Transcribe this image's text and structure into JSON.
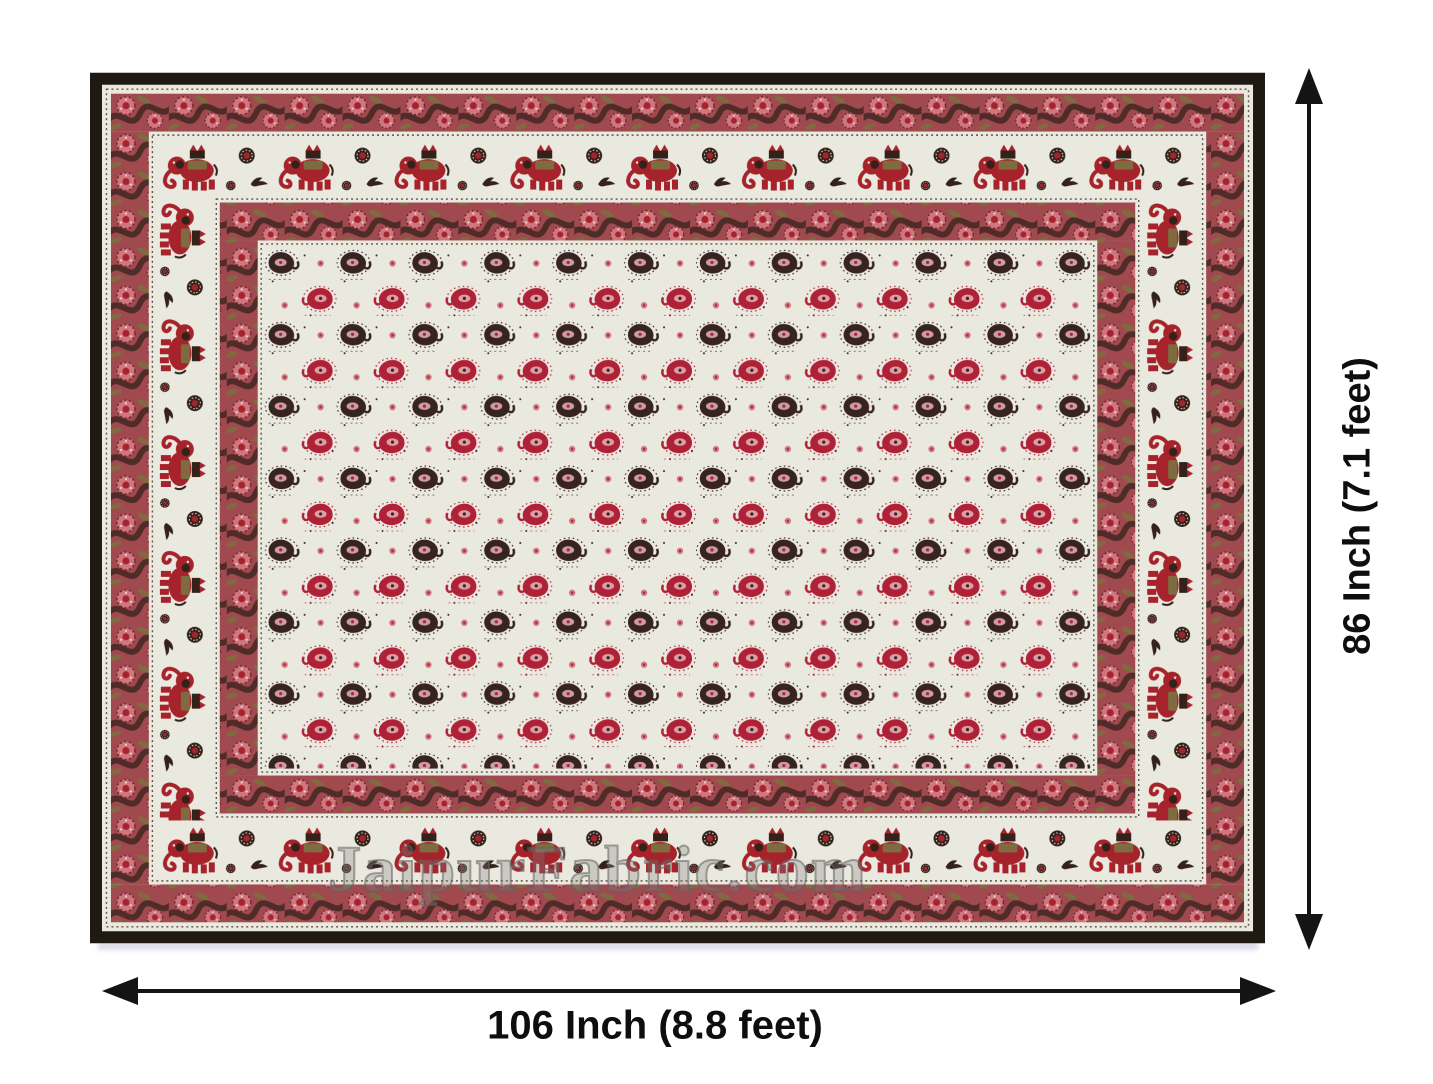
{
  "watermark": {
    "text": "JaipurFabric.com"
  },
  "dimension_labels": {
    "width": "106 Inch (8.8 feet)",
    "height": "86 Inch (7.1 feet)"
  },
  "icons": {
    "width_arrow": "double-headed-arrow-horizontal",
    "height_arrow": "double-headed-arrow-vertical"
  },
  "palette": {
    "page_bg": "#ffffff",
    "arrow_black": "#141414",
    "label_black": "#0e0e0e",
    "edge_black": "#201913",
    "cream": "#eae9df",
    "band_bg": "#a04a50",
    "motif_red": "#a6232b",
    "motif_dark": "#34211a",
    "paisley_dark": "#372322",
    "paisley_red": "#ae2136",
    "pink": "#d0767e",
    "pink_light": "#e6b4b8",
    "olive": "#7e6b40",
    "watermark_gray": "#6a6a6a"
  }
}
